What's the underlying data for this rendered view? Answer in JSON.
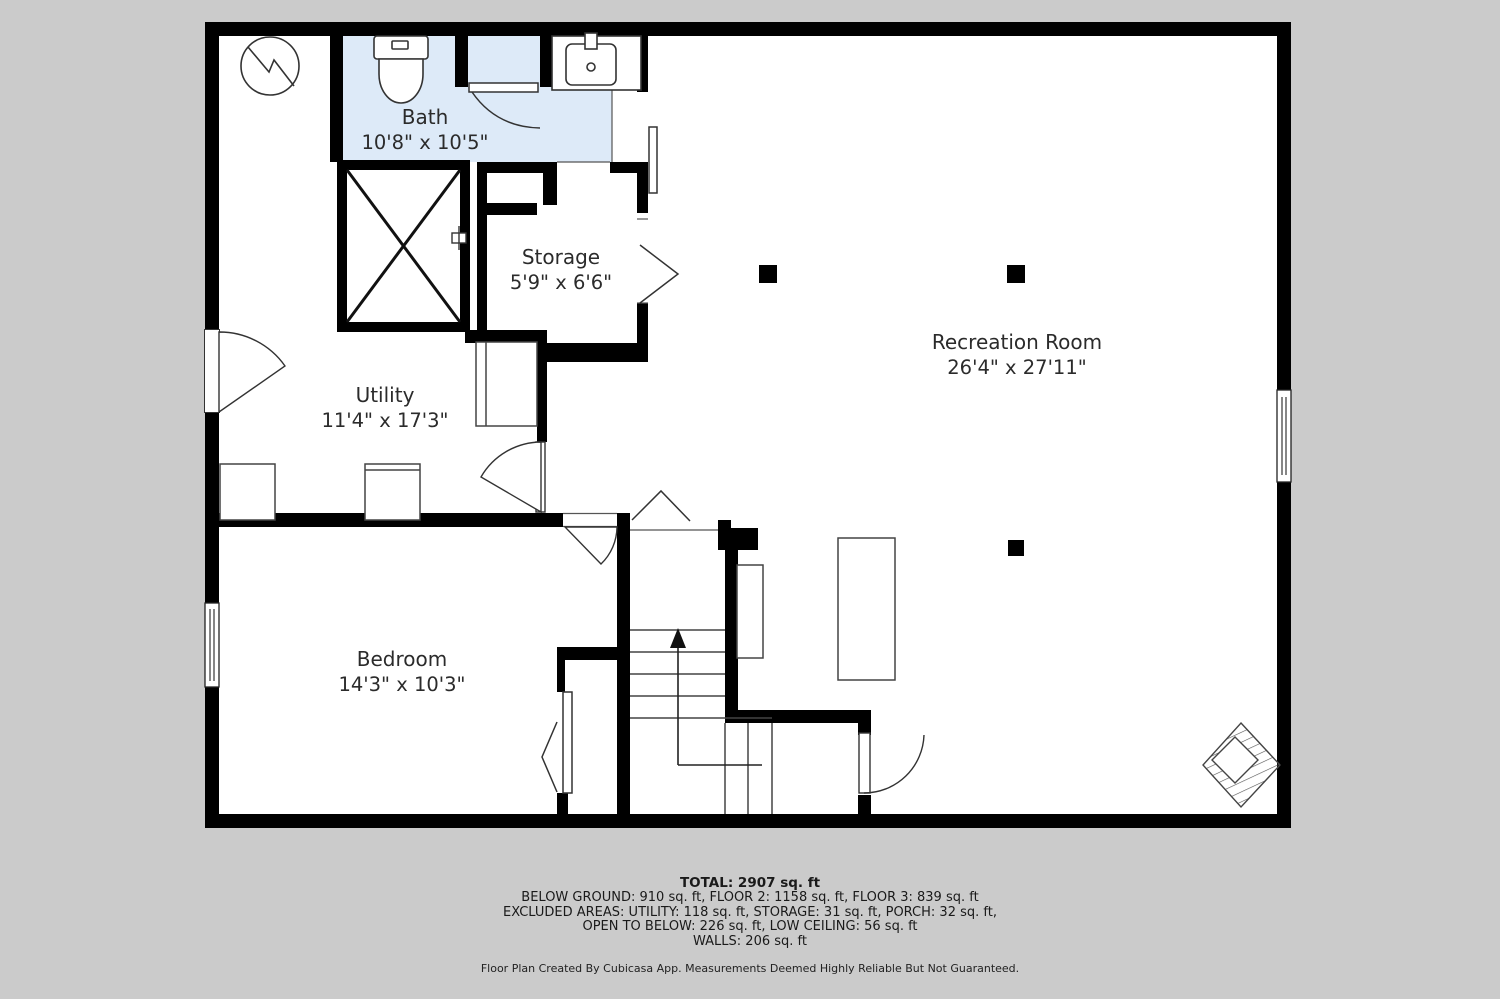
{
  "plan": {
    "title": "Basement floor plan",
    "rooms": [
      {
        "name": "Bath",
        "dims": "10'8\" x 10'5\""
      },
      {
        "name": "Storage",
        "dims": "5'9\" x 6'6\""
      },
      {
        "name": "Utility",
        "dims": "11'4\" x 17'3\""
      },
      {
        "name": "Recreation Room",
        "dims": "26'4\" x 27'11\""
      },
      {
        "name": "Bedroom",
        "dims": "14'3\" x 10'3\""
      }
    ],
    "icons": [
      "electrical-panel-icon",
      "fireplace-icon",
      "stairs-up-arrow",
      "toilet-icon",
      "sink-icon",
      "shower-x"
    ],
    "colors": {
      "wall": "#000000",
      "bath_fill": "#ddeaf8",
      "background": "#cbcbcb",
      "floor": "#ffffff",
      "line": "#3a3a3a"
    }
  },
  "footer": {
    "total": "TOTAL: 2907 sq. ft",
    "line1": "BELOW GROUND: 910 sq. ft, FLOOR 2: 1158 sq. ft, FLOOR 3: 839 sq. ft",
    "line2": "EXCLUDED AREAS: UTILITY: 118 sq. ft, STORAGE: 31 sq. ft, PORCH: 32 sq. ft,",
    "line3": "OPEN TO BELOW: 226 sq. ft, LOW CEILING: 56 sq. ft",
    "line4": "WALLS: 206 sq. ft",
    "disclaimer": "Floor Plan Created By Cubicasa App. Measurements Deemed Highly Reliable But Not Guaranteed."
  }
}
